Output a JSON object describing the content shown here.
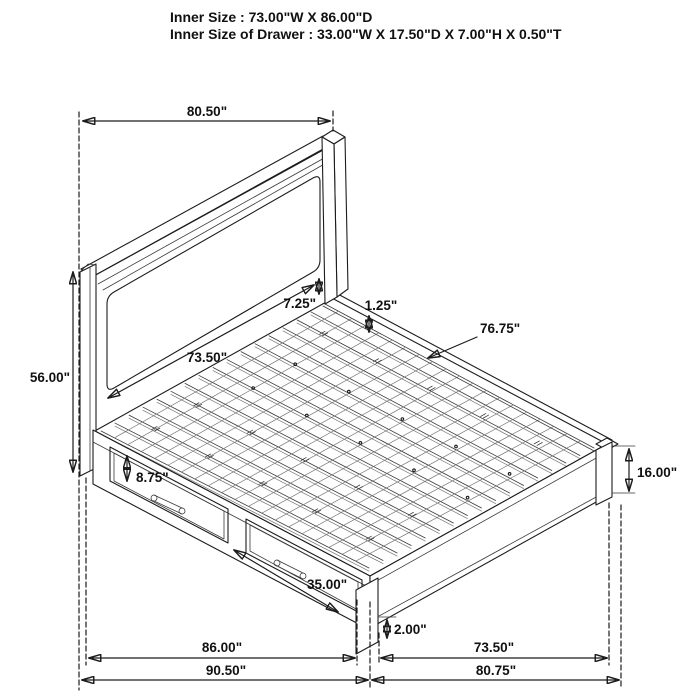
{
  "header": {
    "line1": "Inner Size : 73.00\"W X 86.00\"D",
    "line2": "Inner Size of Drawer : 33.00\"W X 17.50\"D X 7.00\"H X 0.50\"T"
  },
  "dimensions": {
    "headboard_width": "80.50\"",
    "headboard_height": "56.00\"",
    "headboard_panel_width": "73.50\"",
    "panel_to_rail_gap": "7.25\"",
    "slat_thickness": "1.25\"",
    "slat_length": "76.75\"",
    "drawer_front_height": "8.75\"",
    "drawer_front_width": "35.00\"",
    "platform_height": "16.00\"",
    "floor_clearance": "2.00\"",
    "frame_depth": "86.00\"",
    "overall_depth": "90.50\"",
    "footboard_inner_width": "73.50\"",
    "overall_width": "80.75\""
  }
}
